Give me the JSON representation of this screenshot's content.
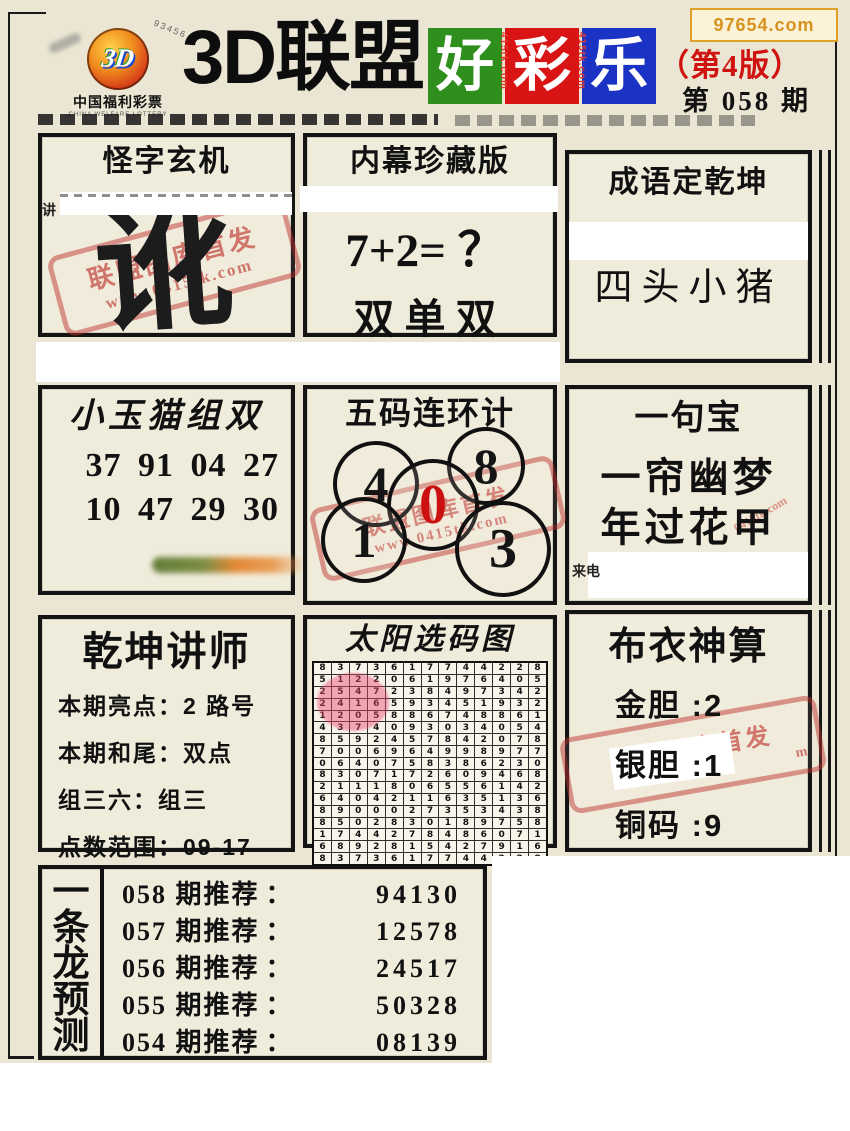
{
  "watermark": "97654.com",
  "logo": {
    "brand": "3D",
    "arc_text": "93456",
    "org": "中国福利彩票",
    "org_en": "CHINA WELFARE LOTTERY"
  },
  "header": {
    "title": "3D联盟",
    "blocks": [
      {
        "char": "好",
        "color": "#2f8f1d"
      },
      {
        "char": "彩",
        "color": "#d91414"
      },
      {
        "char": "乐",
        "color": "#1b33c4"
      }
    ],
    "side_text": "415tk.com",
    "edition": "（第4版）",
    "issue": "第 058 期"
  },
  "boxes": {
    "guai": {
      "title": "怪字玄机",
      "big_char": "讹",
      "side_char": "讲",
      "stamp_line1": "联盟图库首发",
      "stamp_line2": "www.0415tk.com"
    },
    "neimu": {
      "title": "内幕珍藏版",
      "line1": "7+2= ？",
      "line2": "双单双"
    },
    "chengyu": {
      "title": "成语定乾坤",
      "content": "四头小猪"
    },
    "xiaoyumao": {
      "title": "小玉猫组双",
      "line1": "37 91 04 27",
      "line2": "10 47 29 30"
    },
    "wuma": {
      "title": "五码连环计",
      "numbers": [
        "4",
        "8",
        "0",
        "1",
        "3"
      ],
      "stamp_line1": "联盟图库首发",
      "stamp_line2": "www.0415tk.com"
    },
    "yijubao": {
      "title": "一句宝",
      "line1": "一帘幽梦",
      "line2": "年过花甲",
      "corner_text": "来电",
      "faint_text": "0415tk.com"
    },
    "qiankun": {
      "title": "乾坤讲师",
      "separator": "：",
      "rows": [
        {
          "label": "本期亮点",
          "value": "2 路号"
        },
        {
          "label": "本期和尾",
          "value": "双点"
        },
        {
          "label": "组三六",
          "value": "组三"
        },
        {
          "label": "点数范围",
          "value": "09-17"
        }
      ]
    },
    "taiyang": {
      "title": "太阳选码图",
      "grid": [
        "8373617744228",
        "5122061976405",
        "2547238497342",
        "2416593451932",
        "1205886748861",
        "4374093034054",
        "8592457842078",
        "7006964998977",
        "0640758386230",
        "8307172609468",
        "2111806556142",
        "6404211635136",
        "8900027353438",
        "8502830189758",
        "1744278486071",
        "6892815427916",
        "8373617744228"
      ]
    },
    "buyi": {
      "title": "布衣神算",
      "separator": ":",
      "rows": [
        {
          "label": "金胆",
          "value": "2"
        },
        {
          "label": "银胆",
          "value": "1"
        },
        {
          "label": "铜码",
          "value": "9"
        }
      ],
      "stamp_line1": "联盟网库首发",
      "stamp_line2": "m"
    }
  },
  "dragon": {
    "chars": [
      "一",
      "条",
      "龙",
      "预",
      "测"
    ],
    "separator": "：",
    "rows": [
      {
        "label": "058 期推荐",
        "value": "94130"
      },
      {
        "label": "057 期推荐",
        "value": "12578"
      },
      {
        "label": "056 期推荐",
        "value": "24517"
      },
      {
        "label": "055 期推荐",
        "value": "50328"
      },
      {
        "label": "054 期推荐",
        "value": "08139"
      },
      {
        "label": "053 期推荐",
        "value": "19042"
      },
      {
        "label": "052 期推荐",
        "value": "30895"
      }
    ]
  }
}
